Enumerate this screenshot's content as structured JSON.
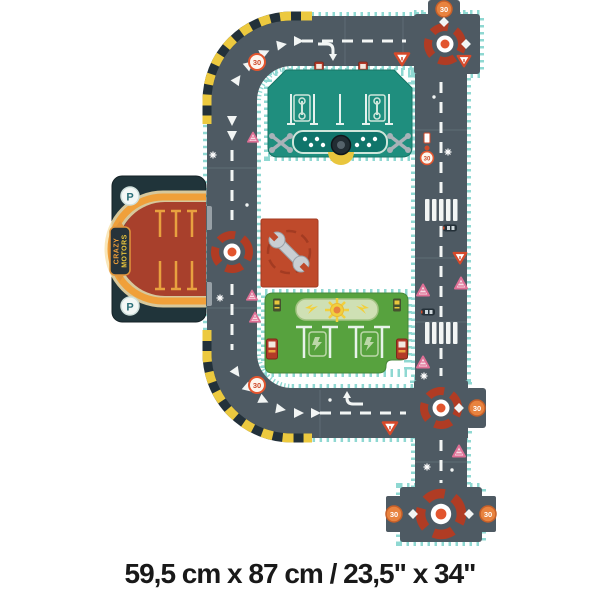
{
  "caption": {
    "dimensions": "59,5 cm x 87 cm / 23,5\" x 34\""
  },
  "garage": {
    "brand_line1": "CRAZY",
    "brand_line2": "MOTORS",
    "parking_letter": "P"
  },
  "signs": {
    "speed_limit": "30"
  },
  "colors": {
    "road": "#4e5a63",
    "puzzle_edge_teal": "#8fd8d2",
    "hazard_yellow": "#ecc93f",
    "hazard_dark": "#23313a",
    "roundabout_red": "#b03c24",
    "roundabout_center": "#e2552e",
    "service_station_green": "#1f8e7e",
    "charging_station_green": "#57a23e",
    "garage_red": "#a8402c",
    "garage_frame": "#20343a",
    "neon_orange": "#f0a03a",
    "repair_tile_red": "#bf4a2b",
    "marking_white": "#f2f5f4",
    "caption_text": "#191919"
  },
  "icons": {
    "repair": "wrench-icon",
    "tire": "tire-icon",
    "fuel": "pump-icon",
    "charging": "lightning-icon",
    "pit_stop": "checkered-dots-icon"
  }
}
